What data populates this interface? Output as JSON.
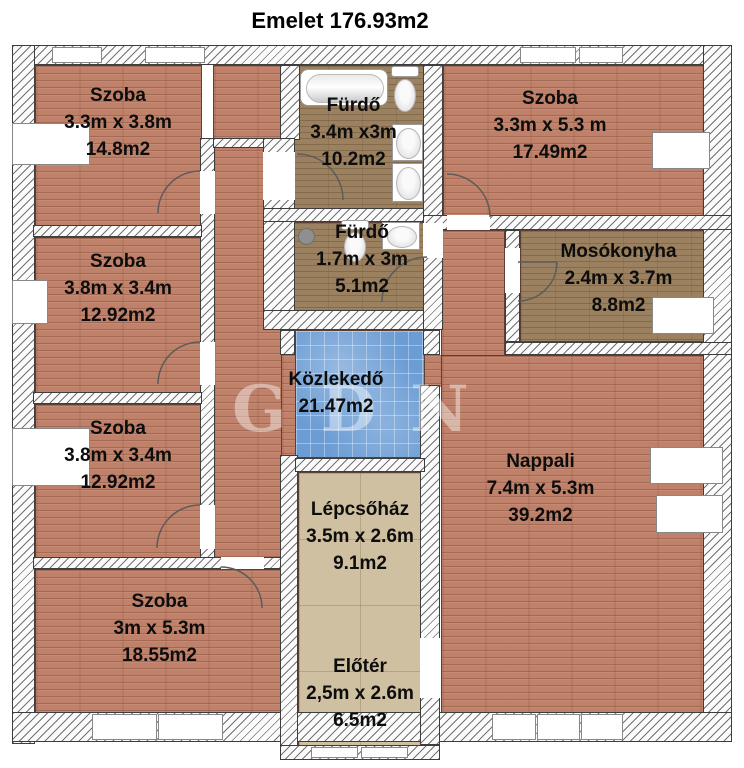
{
  "title": "Emelet 176.93m2",
  "watermark": "GDN",
  "rooms": {
    "szoba_tl": {
      "name": "Szoba",
      "dims": "3.3m x 3.8m",
      "area": "14.8m2"
    },
    "furdo_nagy": {
      "name": "Fürdő",
      "dims": "3.4m x3m",
      "area": "10.2m2"
    },
    "szoba_tr": {
      "name": "Szoba",
      "dims": "3.3m x 5.3 m",
      "area": "17.49m2"
    },
    "szoba_l2": {
      "name": "Szoba",
      "dims": "3.8m x 3.4m",
      "area": "12.92m2"
    },
    "furdo_kis": {
      "name": "Fürdő",
      "dims": "1.7m x 3m",
      "area": "5.1m2"
    },
    "mosokonyha": {
      "name": "Mosókonyha",
      "dims": "2.4m x 3.7m",
      "area": "8.8m2"
    },
    "kozlekedo": {
      "name": "Közlekedő",
      "area": "21.47m2"
    },
    "szoba_l3": {
      "name": "Szoba",
      "dims": "3.8m x 3.4m",
      "area": "12.92m2"
    },
    "nappali": {
      "name": "Nappali",
      "dims": "7.4m x 5.3m",
      "area": "39.2m2"
    },
    "lepcsohaz": {
      "name": "Lépcsőház",
      "dims": "3.5m x 2.6m",
      "area": "9.1m2"
    },
    "szoba_bl": {
      "name": "Szoba",
      "dims": "3m x 5.3m",
      "area": "18.55m2"
    },
    "eloter": {
      "name": "Előtér",
      "dims": "2,5m x 2.6m",
      "area": "6.5m2"
    }
  },
  "colors": {
    "floor_wood": "#bf8169",
    "floor_tile_dark": "#9b815f",
    "floor_tile_blue": "#6b9cd4",
    "floor_tile_beige": "#cfc0a1",
    "wall_fill": "#fbfbfb",
    "text": "#0d0d0d"
  }
}
